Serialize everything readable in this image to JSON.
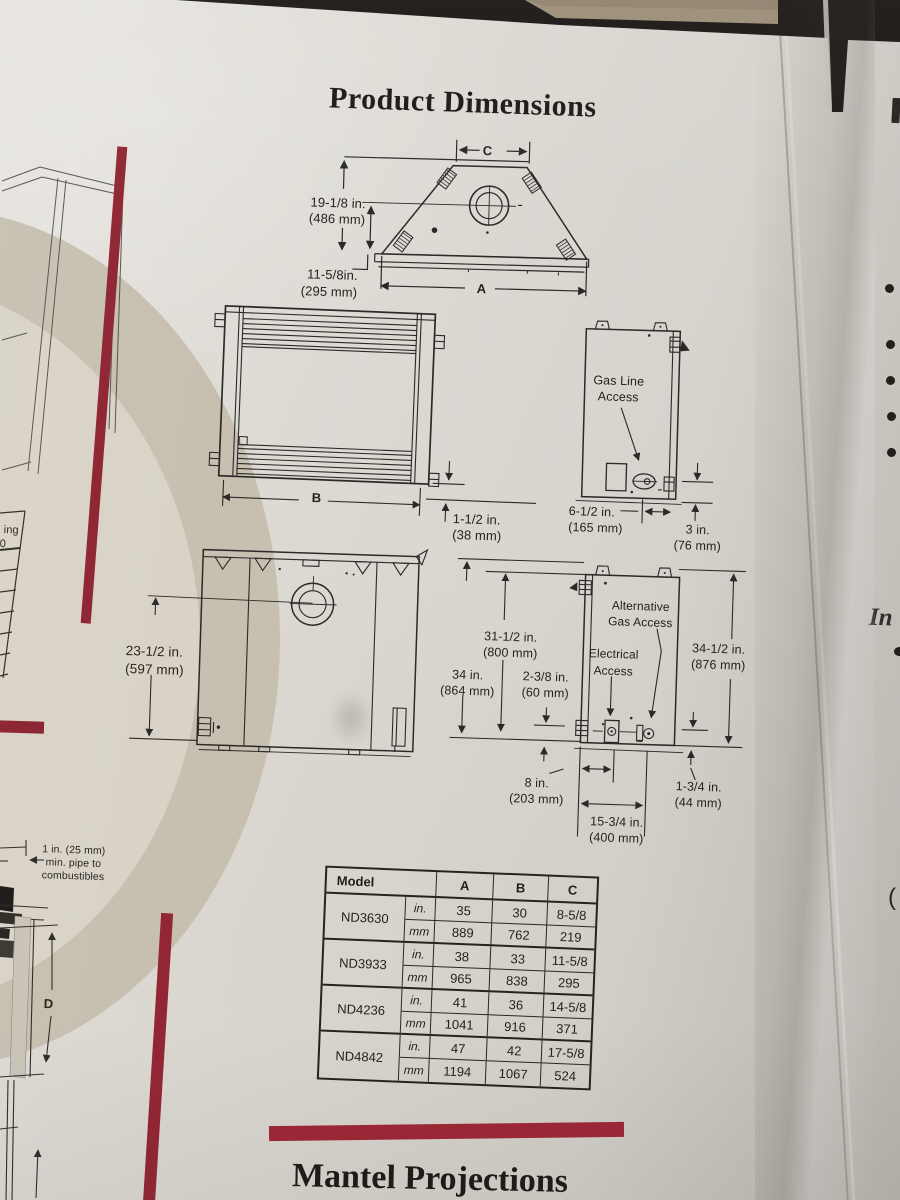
{
  "page": {
    "title": "Product Dimensions",
    "footer_title": "Mantel Projections"
  },
  "top_view": {
    "label_c": "C",
    "label_a": "A",
    "height_in": "19-1/8 in.",
    "height_mm": "(486 mm)",
    "depth_in": "11-5/8in.",
    "depth_mm": "(295 mm)"
  },
  "front_view": {
    "label_b": "B",
    "hearth_in": "1-1/2 in.",
    "hearth_mm": "(38 mm)"
  },
  "gas_side_view": {
    "access_line1": "Gas Line",
    "access_line2": "Access",
    "offset_in": "6-1/2 in.",
    "offset_mm": "(165 mm)",
    "clearance_in": "3 in.",
    "clearance_mm": "(76 mm)"
  },
  "back_view": {
    "flue_in": "23-1/2 in.",
    "flue_mm": "(597 mm)"
  },
  "service_side_view": {
    "alt_gas_line1": "Alternative",
    "alt_gas_line2": "Gas Access",
    "elec_line1": "Electrical",
    "elec_line2": "Access",
    "h800_in": "31-1/2 in.",
    "h800_mm": "(800 mm)",
    "h864_in": "34 in.",
    "h864_mm": "(864 mm)",
    "d60_in": "2-3/8 in.",
    "d60_mm": "(60 mm)",
    "h876_in": "34-1/2 in.",
    "h876_mm": "(876 mm)",
    "w203_in": "8 in.",
    "w203_mm": "(203 mm)",
    "w44_in": "1-3/4 in.",
    "w44_mm": "(44 mm)",
    "w400_in": "15-3/4 in.",
    "w400_mm": "(400 mm)"
  },
  "dimensions_table": {
    "col_model": "Model",
    "col_a": "A",
    "col_b": "B",
    "col_c": "C",
    "unit_in": "in.",
    "unit_mm": "mm",
    "rows": [
      {
        "model": "ND3630",
        "in_a": "35",
        "in_b": "30",
        "in_c": "8-5/8",
        "mm_a": "889",
        "mm_b": "762",
        "mm_c": "219"
      },
      {
        "model": "ND3933",
        "in_a": "38",
        "in_b": "33",
        "in_c": "11-5/8",
        "mm_a": "965",
        "mm_b": "838",
        "mm_c": "295"
      },
      {
        "model": "ND4236",
        "in_a": "41",
        "in_b": "36",
        "in_c": "14-5/8",
        "mm_a": "1041",
        "mm_b": "916",
        "mm_c": "371"
      },
      {
        "model": "ND4842",
        "in_a": "47",
        "in_b": "42",
        "in_c": "17-5/8",
        "mm_a": "1194",
        "mm_b": "1067",
        "mm_c": "524"
      }
    ]
  },
  "left_panel": {
    "pipe_note_line1": "1 in. (25 mm)",
    "pipe_note_line2": "min. pipe to",
    "pipe_note_line3": "combustibles",
    "label_d": "D",
    "partial_text": "ing",
    "partial_text2": "0"
  },
  "right_panel": {
    "partial_text": "In",
    "partial_paren": "("
  },
  "colors": {
    "accent_red": "#8e2330",
    "paper": "#d8d5cf",
    "ink": "#2b2a28"
  }
}
